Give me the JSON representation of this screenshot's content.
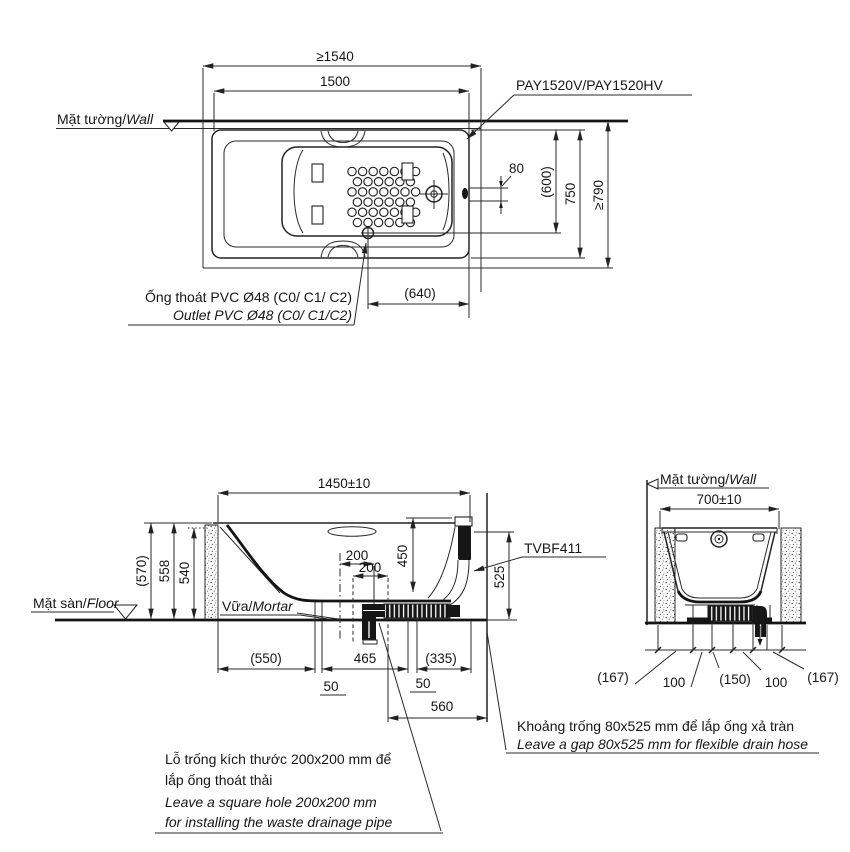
{
  "page": {
    "background": "#ffffff",
    "line_color": "#222222"
  },
  "top_view": {
    "wall_label": {
      "vi": "Mặt tường/",
      "en": "Wall"
    },
    "model_label": "PAY1520V/PAY1520HV",
    "outlet_label": {
      "vi": "Ống thoát PVC Ø48 (C0/ C1/ C2)",
      "en": "Outlet PVC Ø48 (C0/ C1/C2)"
    },
    "dims": {
      "niche_length": "≥1540",
      "tub_length": "1500",
      "overflow_offset": "80",
      "drain_to_wall": "(600)",
      "tub_width": "750",
      "niche_width": "≥790",
      "outlet_to_end": "(640)"
    }
  },
  "side_view": {
    "dims": {
      "length": "1450±10",
      "height_overall": "(570)",
      "height_rim": "558",
      "height_inner": "540",
      "hole_offset": "200",
      "hole_size": "200",
      "depth": "450",
      "overflow_gap_height": "525",
      "back_clearance": "(550)",
      "trap_span": "465",
      "front_clearance": "(335)",
      "gap_a": "50",
      "gap_b": "50",
      "hose_clearance": "560"
    },
    "drain_label": "TVBF411",
    "floor_label": {
      "vi": "Mặt sàn/",
      "en": "Floor"
    },
    "mortar_label": {
      "vi": "Vữa/",
      "en": "Mortar"
    }
  },
  "end_view": {
    "wall_label": {
      "vi": "Mặt tường/",
      "en": "Wall"
    },
    "dims": {
      "width": "700±10",
      "s1": "(167)",
      "s2": "100",
      "s3": "(150)",
      "s4": "100",
      "s5": "(167)"
    }
  },
  "notes": {
    "gap": {
      "vi": "Khoảng trống 80x525 mm để lắp ống xả tràn",
      "en": "Leave a gap 80x525 mm for flexible drain hose"
    },
    "hole": {
      "vi1": "Lỗ trống kích thước 200x200 mm để",
      "vi2": "lắp ống thoát thải",
      "en1": "Leave a square hole  200x200 mm",
      "en2": "for installing the waste drainage pipe"
    }
  }
}
